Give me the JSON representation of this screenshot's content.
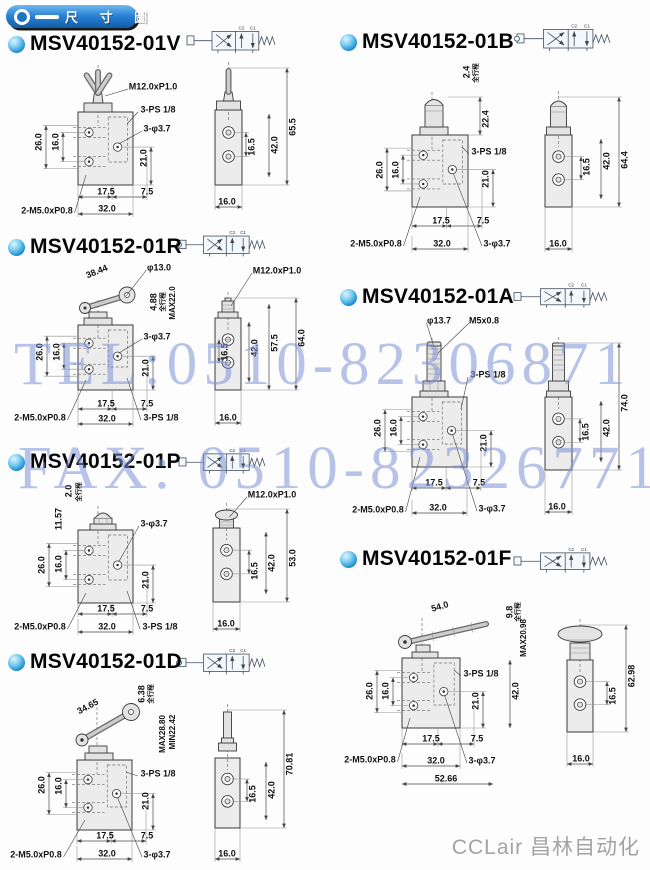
{
  "header": {
    "title": "尺 寸 圖"
  },
  "watermark": {
    "line1": "TEL:0510-82306871",
    "line2": "FAX: 0510-82326771"
  },
  "footer": {
    "brand": "CCLair 昌林自动化"
  },
  "symbol_ports": [
    "C2",
    "C1"
  ],
  "colors": {
    "accent_blue": "#1d7cc9",
    "bullet_cyan": "#2aa3e0",
    "watermark_blue": "#7c92d6",
    "line_dark": "#3a3a3a",
    "body_gray": "#ececec",
    "footer_gray": "#a3a3a3"
  },
  "sections": [
    {
      "id": "01V",
      "title": "MSV40152-01V",
      "actuator": "toggle-lever",
      "annotations": [
        [
          "M12.0xP1.0",
          153,
          87,
          0
        ],
        [
          "3-PS 1/8",
          158,
          110,
          0
        ],
        [
          "3-φ3.7",
          157,
          129,
          0
        ],
        [
          "26.0",
          39,
          142,
          -90
        ],
        [
          "16.0",
          56,
          142,
          -90
        ],
        [
          "21.0",
          144,
          158,
          -90
        ],
        [
          "17.5",
          106,
          192,
          0
        ],
        [
          "7.5",
          147,
          192,
          0
        ],
        [
          "32.0",
          107,
          209,
          0
        ],
        [
          "2-M5.0xP0.8",
          47,
          211,
          0
        ],
        [
          "16.5",
          252,
          147,
          -90
        ],
        [
          "42.0",
          275,
          145,
          -90
        ],
        [
          "65.5",
          293,
          127,
          -90
        ],
        [
          "16.0",
          227,
          202,
          0
        ]
      ]
    },
    {
      "id": "01B",
      "title": "MSV40152-01B",
      "actuator": "push-button",
      "annotations": [
        [
          "2.4",
          467,
          72,
          -90
        ],
        [
          "全行程",
          476,
          73,
          -90,
          6.5
        ],
        [
          "22.4",
          486,
          119,
          -90
        ],
        [
          "3-PS 1/8",
          489,
          152,
          0
        ],
        [
          "26.0",
          380,
          170,
          -90
        ],
        [
          "16.0",
          396,
          170,
          -90
        ],
        [
          "21.0",
          486,
          179,
          -90
        ],
        [
          "17.5",
          441,
          221,
          0
        ],
        [
          "7.5",
          483,
          221,
          0
        ],
        [
          "32.0",
          442,
          244,
          0
        ],
        [
          "2-M5.0xP0.8",
          376,
          244,
          0
        ],
        [
          "3-φ3.7",
          497,
          244,
          0
        ],
        [
          "16.5",
          587,
          167,
          -90
        ],
        [
          "42.0",
          607,
          161,
          -90
        ],
        [
          "64.4",
          625,
          160,
          -90
        ],
        [
          "16.0",
          558,
          244,
          0
        ]
      ]
    },
    {
      "id": "01R",
      "title": "MSV40152-01R",
      "actuator": "roller-lever",
      "annotations": [
        [
          "38.44",
          97,
          272,
          -22
        ],
        [
          "φ13.0",
          159,
          268,
          0
        ],
        [
          "M12.0xP1.0",
          277,
          271,
          0
        ],
        [
          "4.88",
          154,
          302,
          -90
        ],
        [
          "全行程",
          163,
          302,
          -90,
          6.5
        ],
        [
          "MAX22.0",
          173,
          303,
          -90,
          8
        ],
        [
          "26.0",
          40,
          352,
          -90
        ],
        [
          "16.0",
          57,
          352,
          -90
        ],
        [
          "3-φ3.7",
          157,
          337,
          0
        ],
        [
          "21.0",
          146,
          368,
          -90
        ],
        [
          "17.5",
          106,
          404,
          0
        ],
        [
          "7.5",
          147,
          404,
          0
        ],
        [
          "32.0",
          107,
          419,
          0
        ],
        [
          "2-M5.0xP0.8",
          40,
          418,
          0
        ],
        [
          "3-PS 1/8",
          161,
          418,
          0
        ],
        [
          "16.5",
          225,
          352,
          -90
        ],
        [
          "42.0",
          255,
          348,
          -90
        ],
        [
          "57.5",
          275,
          343,
          -90
        ],
        [
          "64.0",
          302,
          338,
          -90
        ],
        [
          "16.0",
          228,
          418,
          0
        ]
      ]
    },
    {
      "id": "01A",
      "title": "MSV40152-01A",
      "actuator": "plunger-stem",
      "annotations": [
        [
          "φ13.7",
          439,
          321,
          0
        ],
        [
          "M5x0.8",
          484,
          321,
          0
        ],
        [
          "3-PS 1/8",
          488,
          375,
          0
        ],
        [
          "26.0",
          378,
          428,
          -90
        ],
        [
          "16.0",
          394,
          428,
          -90
        ],
        [
          "21.0",
          484,
          443,
          -90
        ],
        [
          "17.5",
          434,
          483,
          0
        ],
        [
          "7.5",
          479,
          483,
          0
        ],
        [
          "32.0",
          438,
          508,
          0
        ],
        [
          "2-M5.0xP0.8",
          378,
          510,
          0
        ],
        [
          "3-φ3.7",
          492,
          509,
          0
        ],
        [
          "16.5",
          586,
          432,
          -90
        ],
        [
          "42.0",
          607,
          428,
          -90
        ],
        [
          "74.0",
          625,
          403,
          -90
        ],
        [
          "16.0",
          557,
          507,
          0
        ]
      ]
    },
    {
      "id": "01P",
      "title": "MSV40152-01P",
      "actuator": "pin-button",
      "annotations": [
        [
          "2.0",
          69,
          491,
          -90
        ],
        [
          "全行程",
          79,
          492,
          -90,
          6.5
        ],
        [
          "11.57",
          59,
          519,
          -90
        ],
        [
          "3-φ3.7",
          154,
          524,
          0
        ],
        [
          "M12.0xP1.0",
          272,
          495,
          0
        ],
        [
          "26.0",
          42,
          565,
          -90
        ],
        [
          "16.0",
          59,
          564,
          -90
        ],
        [
          "21.0",
          146,
          580,
          -90
        ],
        [
          "17.5",
          106,
          609,
          0
        ],
        [
          "7.5",
          147,
          609,
          0
        ],
        [
          "32.0",
          107,
          627,
          0
        ],
        [
          "2-M5.0xP0.8",
          40,
          627,
          0
        ],
        [
          "3-PS 1/8",
          160,
          627,
          0
        ],
        [
          "16.5",
          255,
          571,
          -90
        ],
        [
          "42.0",
          272,
          563,
          -90
        ],
        [
          "53.0",
          293,
          558,
          -90
        ],
        [
          "16.0",
          226,
          624,
          0
        ]
      ]
    },
    {
      "id": "01F",
      "title": "MSV40152-01F",
      "actuator": "foot-pedal",
      "annotations": [
        [
          "54.0",
          440,
          607,
          -16
        ],
        [
          "9.8",
          510,
          612,
          -90
        ],
        [
          "全行程",
          518,
          612,
          -90,
          6.5
        ],
        [
          "MAX20.98",
          524,
          638,
          -90,
          8
        ],
        [
          "3-PS 1/8",
          481,
          674,
          0
        ],
        [
          "26.0",
          370,
          691,
          -90
        ],
        [
          "16.0",
          386,
          691,
          -90
        ],
        [
          "21.0",
          476,
          701,
          -90
        ],
        [
          "42.0",
          516,
          691,
          -90
        ],
        [
          "17.5",
          431,
          739,
          0
        ],
        [
          "7.5",
          477,
          739,
          0
        ],
        [
          "32.0",
          436,
          761,
          0
        ],
        [
          "2-M5.0xP0.8",
          370,
          760,
          0
        ],
        [
          "3-φ3.7",
          482,
          761,
          0
        ],
        [
          "52.66",
          446,
          779,
          0
        ],
        [
          "16.5",
          613,
          696,
          -90
        ],
        [
          "62.98",
          632,
          676,
          -90
        ],
        [
          "16.0",
          581,
          759,
          0
        ]
      ]
    },
    {
      "id": "01D",
      "title": "MSV40152-01D",
      "actuator": "roller-plunger",
      "annotations": [
        [
          "34.65",
          88,
          707,
          -28
        ],
        [
          "6.38",
          142,
          694,
          -90
        ],
        [
          "全行程",
          151,
          694,
          -90,
          6.5
        ],
        [
          "MAX28.80",
          163,
          734,
          -90,
          8
        ],
        [
          "MIN22.42",
          173,
          732,
          -90,
          8
        ],
        [
          "3-PS 1/8",
          158,
          774,
          0
        ],
        [
          "26.0",
          42,
          785,
          -90
        ],
        [
          "16.0",
          59,
          786,
          -90
        ],
        [
          "21.0",
          146,
          801,
          -90
        ],
        [
          "17.5",
          105,
          836,
          0
        ],
        [
          "7.5",
          147,
          836,
          0
        ],
        [
          "32.0",
          107,
          854,
          0
        ],
        [
          "2-M5.0xP0.8",
          36,
          855,
          0
        ],
        [
          "3-φ3.7",
          157,
          855,
          0
        ],
        [
          "16.5",
          253,
          794,
          -90
        ],
        [
          "42.0",
          272,
          790,
          -90
        ],
        [
          "70.81",
          290,
          764,
          -90
        ],
        [
          "16.0",
          227,
          854,
          0
        ]
      ]
    }
  ]
}
